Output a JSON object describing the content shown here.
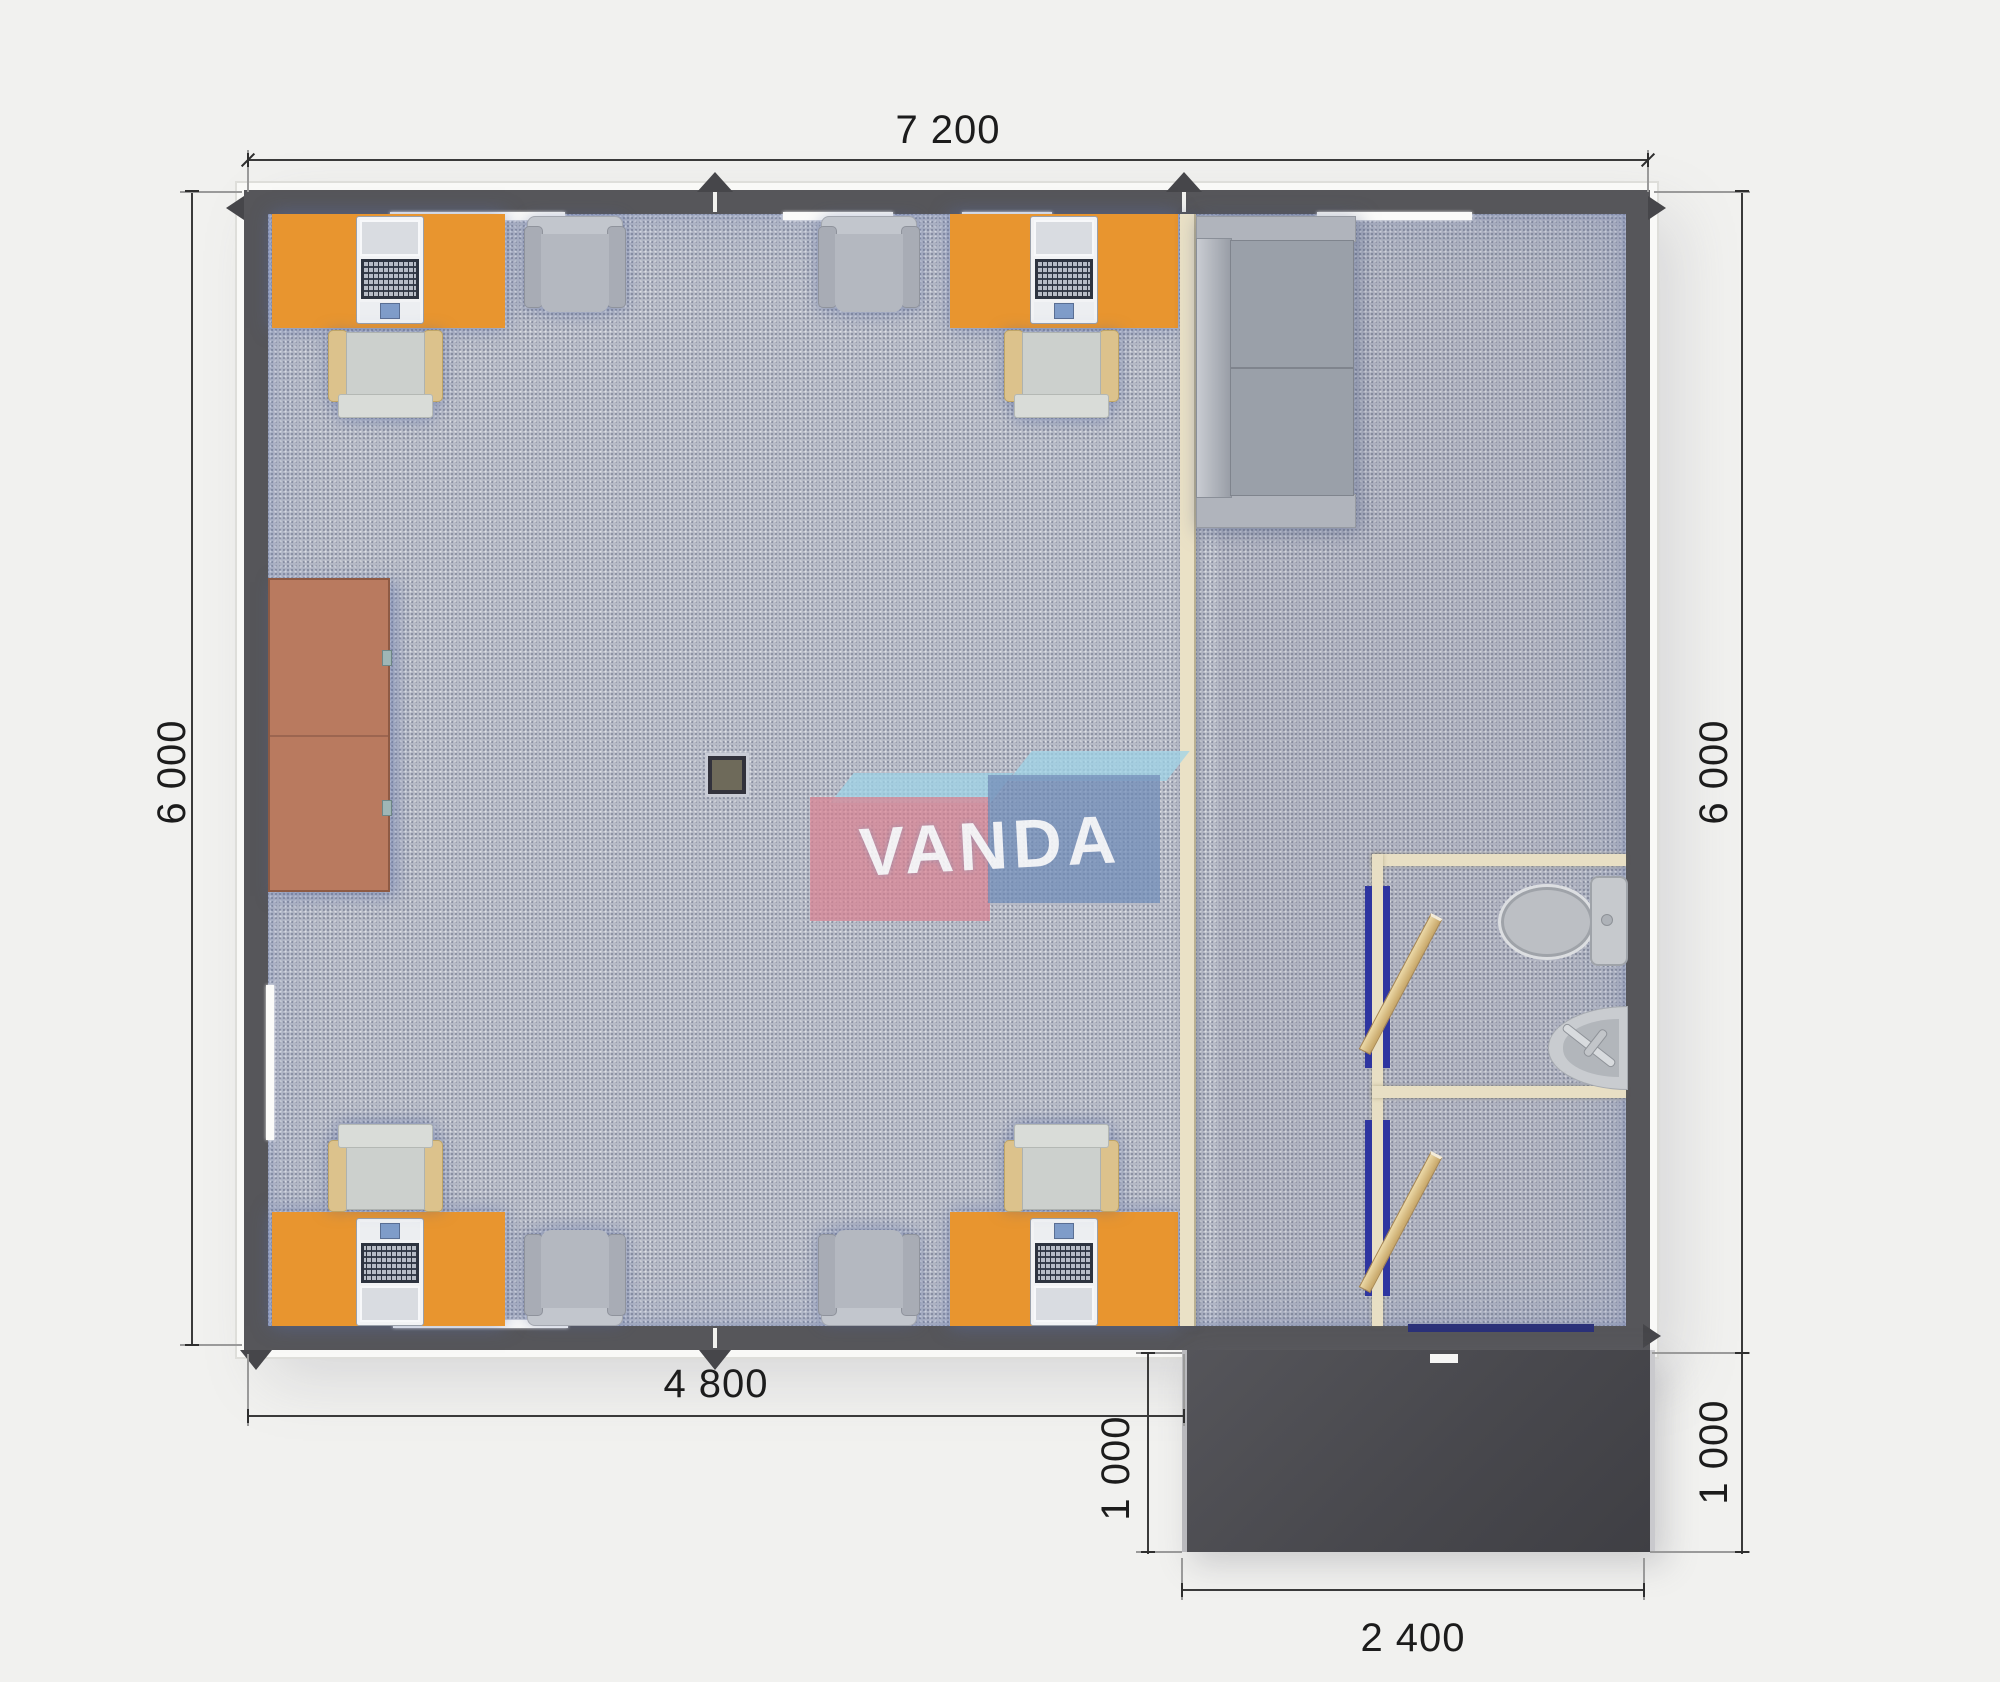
{
  "watermark": {
    "text": "VANDA"
  },
  "dimensions": {
    "top": "7 200",
    "left": "6 000",
    "right": "6 000",
    "bottom_inner": "4 800",
    "porch_left": "1 000",
    "porch_right": "1 000",
    "porch_bottom": "2 400"
  },
  "colors": {
    "desk_orange": "#E8952F",
    "cabinet_brown": "#B97A5F",
    "carpet_gray": "#B6BAC6",
    "wall_dark": "#56565A",
    "partition_beige": "#EAE1C6",
    "porch_dark": "#4B4B50",
    "door_frame_blue": "#2E35A0",
    "door_leaf_tan": "#D9B97F",
    "logo_pink": "#DD808F",
    "logo_blue": "#6E8CB9",
    "logo_light_blue": "#9FD3E8"
  }
}
